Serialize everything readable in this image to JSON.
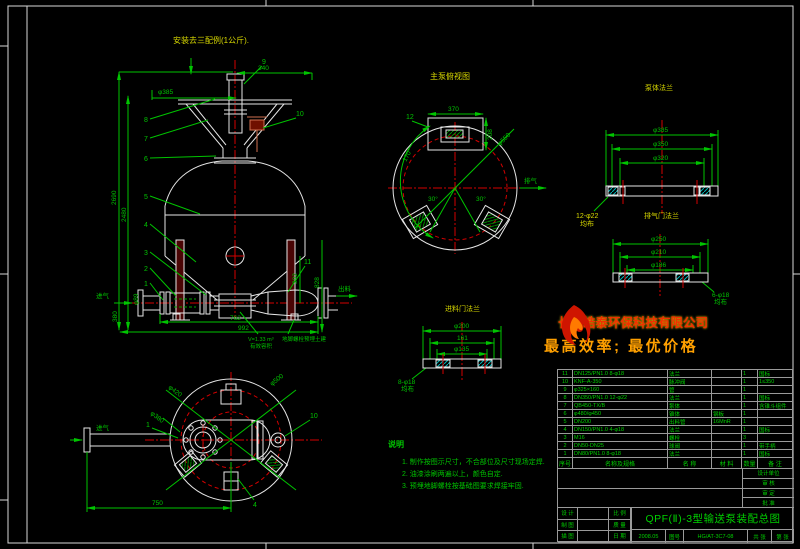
{
  "install_note": "安装去三配例(1公斤).",
  "main_view": {
    "dims": {
      "top_width": "340",
      "top_flange": "φ385",
      "height_outer": "2690",
      "height_inner": "2480",
      "bottom_inner": "762",
      "bottom_total": "992",
      "left_height": "380",
      "left_pipe": "φ89",
      "right_total": "828",
      "right_lower": "302"
    },
    "labels": {
      "inlet": "进气",
      "outlet": "出料",
      "volume_line1": "V=1.33 m³",
      "volume_line2": "有效容积",
      "anchor_note": "地脚螺栓预埋土建"
    },
    "leaders_left": [
      "8",
      "7",
      "6",
      "5",
      "4",
      "3",
      "2",
      "1"
    ],
    "leaders_right": [
      "9",
      "10",
      "11"
    ]
  },
  "top_view": {
    "title": "主泵俯视图",
    "dim_width": "370",
    "dim_side": "208",
    "angle_left": "170°",
    "angle_a": "30°",
    "angle_b": "30°",
    "diag": "φ550",
    "leader": "12",
    "label_right": "排气"
  },
  "flange_a": {
    "title": "泵体法兰",
    "d1": "φ385",
    "d2": "φ350",
    "d3": "φ320",
    "holes": "12-φ22",
    "dist": "均布"
  },
  "flange_b": {
    "title": "排气门法兰",
    "d1": "φ250",
    "d2": "φ210",
    "d3": "φ186",
    "holes": "6-φ18",
    "dist": "均布"
  },
  "flange_c": {
    "title": "进料门法兰",
    "d1": "φ200",
    "d2": "161",
    "d3": "φ135",
    "holes": "8-φ18",
    "dist": "均布"
  },
  "bottom_view": {
    "diag_left": "φ420",
    "diag_right": "φ500",
    "bolt_circle": "φ380",
    "width": "750",
    "inlet": "进气",
    "leader_1": "1",
    "leader_10": "10",
    "leader_4": "4"
  },
  "notes": {
    "title": "说明",
    "items": [
      "1. 制作按图示尺寸，不合部位及尺寸现场定焊.",
      "2. 油漆涂刷两遍以上，颜色自定.",
      "3. 预埋地脚螺栓按基础图要求焊接牢固."
    ]
  },
  "logo": {
    "company": "长沙皓泰环保科技有限公司",
    "slogan": "最高效率; 最优价格"
  },
  "bom": {
    "headers": [
      "序号",
      "名称及规格",
      "名 称",
      "材 料",
      "数量",
      "备 注"
    ],
    "rows": [
      {
        "no": "11",
        "spec": "DN125/PN1.0 8-φ18",
        "name": "法兰",
        "material": "",
        "qty": "1",
        "remark": "国标"
      },
      {
        "no": "10",
        "spec": "KNF-A-350",
        "name": "脉冲阀",
        "material": "",
        "qty": "1",
        "remark": "1≤350"
      },
      {
        "no": "9",
        "spec": "φ325×160",
        "name": "管",
        "material": "",
        "qty": "1",
        "remark": ""
      },
      {
        "no": "8",
        "spec": "DN350/PN1.0 12-φ22",
        "name": "法兰",
        "material": "",
        "qty": "1",
        "remark": "国标"
      },
      {
        "no": "7",
        "spec": "QB450-TX/B",
        "name": "泵体",
        "material": "",
        "qty": "1",
        "remark": "含锥斗组件"
      },
      {
        "no": "6",
        "spec": "φ480/φ450",
        "name": "锥体",
        "material": "钢板",
        "qty": "1",
        "remark": ""
      },
      {
        "no": "5",
        "spec": "DN200",
        "name": "出料管",
        "material": "16MnR",
        "qty": "1",
        "remark": ""
      },
      {
        "no": "4",
        "spec": "DN150/PN1.0 4-φ18",
        "name": "法兰",
        "material": "",
        "qty": "1",
        "remark": "国标"
      },
      {
        "no": "3",
        "spec": "M16",
        "name": "螺栓",
        "material": "",
        "qty": "3",
        "remark": ""
      },
      {
        "no": "2",
        "spec": "DN50-DN25",
        "name": "球阀",
        "material": "",
        "qty": "1",
        "remark": "带手柄"
      },
      {
        "no": "1",
        "spec": "DN80/PN1.0 8-φ18",
        "name": "法兰",
        "material": "",
        "qty": "1",
        "remark": "国标"
      }
    ]
  },
  "titleblock": {
    "info_labels": [
      "设计单位",
      "审 核",
      "审 定",
      "批 准"
    ],
    "left_rows": [
      "设 计",
      "制 图",
      "描 图"
    ],
    "mid_labels": [
      "比 例",
      "质 量",
      "日 期"
    ],
    "date": "2008.05",
    "title": "QPF(Ⅱ)-3型输送泵装配总图",
    "no_label": "图号",
    "drawing_no": "HG/AT-3C7-08",
    "sheets_a": "共 张",
    "sheets_b": "第 张"
  }
}
